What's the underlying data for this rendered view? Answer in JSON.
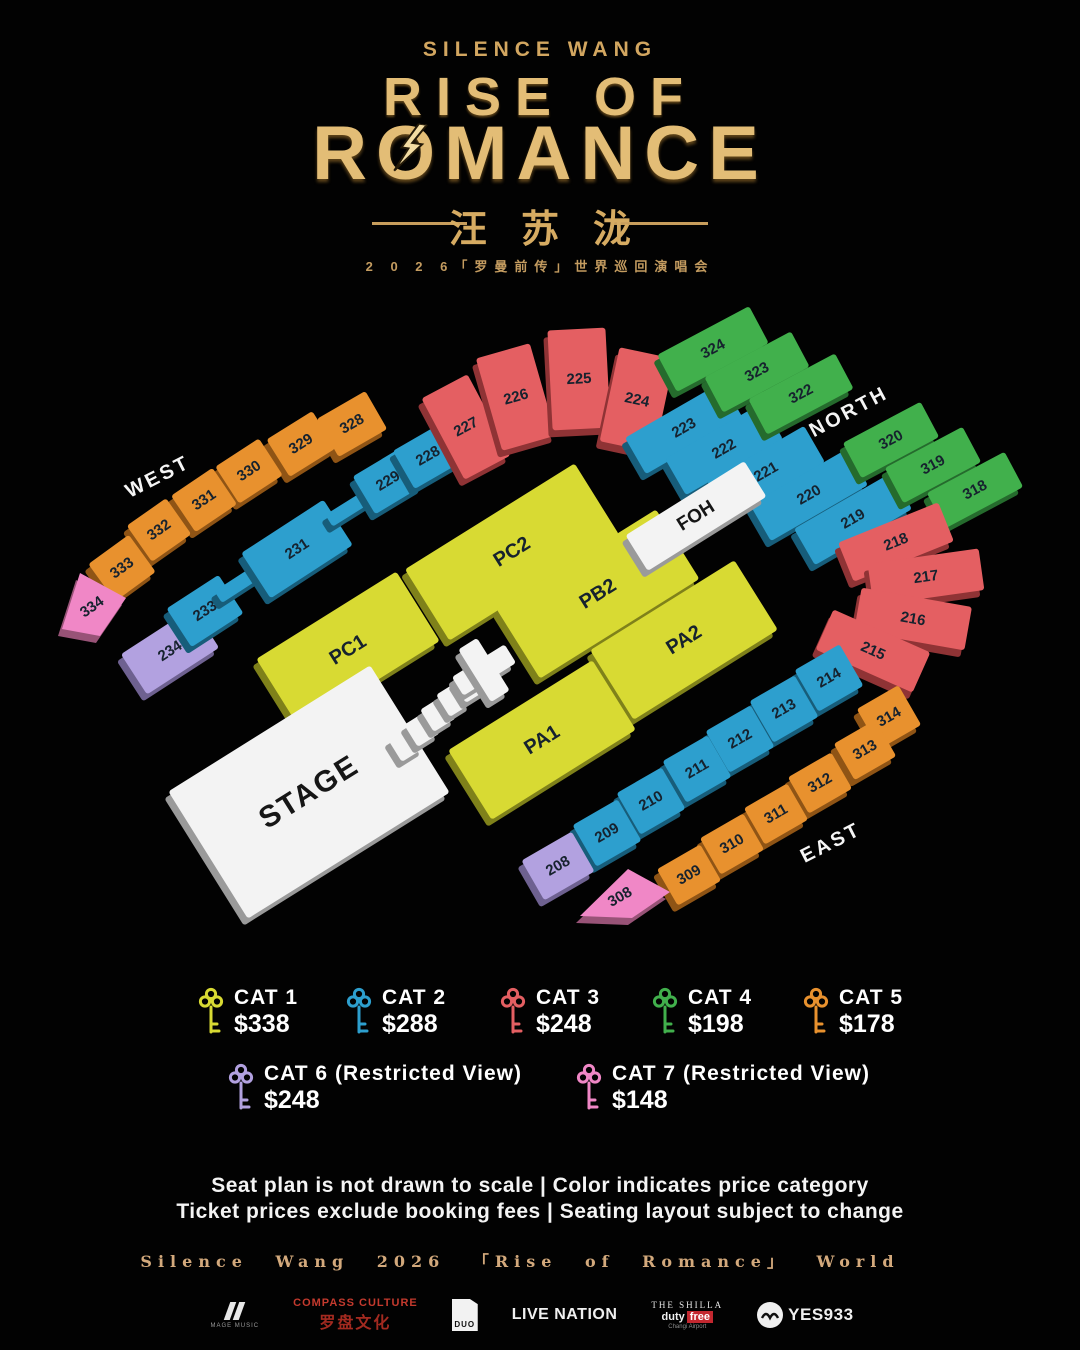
{
  "header": {
    "artist": "SILENCE WANG",
    "title_line1": "RISE OF",
    "title_r": "R",
    "title_o": "O",
    "title_rest": "MANCE",
    "title_cn": "汪苏泷",
    "subtitle": "2 0 2 6「罗曼前传」世界巡回演唱会"
  },
  "map": {
    "label_color": "#16222e",
    "compass": [
      {
        "label": "WEST",
        "x": 158,
        "y": 477,
        "rot": -27
      },
      {
        "label": "NORTH",
        "x": 849,
        "y": 412,
        "rot": -28
      },
      {
        "label": "EAST",
        "x": 831,
        "y": 843,
        "rot": -27
      }
    ],
    "sections": [
      {
        "id": "328",
        "cat": "cat5",
        "cx": 352,
        "cy": 424,
        "w": 56,
        "h": 44,
        "rot": -30
      },
      {
        "id": "329",
        "cat": "cat5",
        "cx": 301,
        "cy": 444,
        "w": 54,
        "h": 44,
        "rot": -32
      },
      {
        "id": "330",
        "cat": "cat5",
        "cx": 249,
        "cy": 471,
        "w": 52,
        "h": 44,
        "rot": -33
      },
      {
        "id": "331",
        "cat": "cat5",
        "cx": 204,
        "cy": 500,
        "w": 50,
        "h": 44,
        "rot": -34
      },
      {
        "id": "332",
        "cat": "cat5",
        "cx": 159,
        "cy": 530,
        "w": 48,
        "h": 44,
        "rot": -35
      },
      {
        "id": "333",
        "cat": "cat5",
        "cx": 122,
        "cy": 568,
        "w": 50,
        "h": 46,
        "rot": -36
      },
      {
        "id": "334",
        "cat": "cat7",
        "shape": "poly",
        "points": "62,629 80,573 126,598 100,636",
        "lx": 92,
        "ly": 607,
        "rot": -35
      },
      {
        "id": "234",
        "cat": "cat6",
        "cx": 170,
        "cy": 651,
        "w": 86,
        "h": 48,
        "rot": -33
      },
      {
        "id": "233",
        "cat": "cat2",
        "cx": 205,
        "cy": 611,
        "w": 62,
        "h": 46,
        "rot": -33
      },
      {
        "id": "",
        "cat": "cat2",
        "cx": 240,
        "cy": 583,
        "w": 52,
        "h": 14,
        "rot": -33
      },
      {
        "id": "231",
        "cat": "cat2",
        "cx": 297,
        "cy": 549,
        "w": 98,
        "h": 54,
        "rot": -33
      },
      {
        "id": "",
        "cat": "cat2",
        "cx": 351,
        "cy": 507,
        "w": 52,
        "h": 14,
        "rot": -32
      },
      {
        "id": "229",
        "cat": "cat2",
        "cx": 388,
        "cy": 481,
        "w": 56,
        "h": 44,
        "rot": -31
      },
      {
        "id": "228",
        "cat": "cat2",
        "cx": 428,
        "cy": 456,
        "w": 56,
        "h": 44,
        "rot": -30
      },
      {
        "id": "227",
        "cat": "cat3",
        "cx": 466,
        "cy": 427,
        "w": 52,
        "h": 92,
        "rot": -28
      },
      {
        "id": "226",
        "cat": "cat3",
        "cx": 516,
        "cy": 397,
        "w": 56,
        "h": 96,
        "rot": -16
      },
      {
        "id": "225",
        "cat": "cat3",
        "cx": 579,
        "cy": 379,
        "w": 58,
        "h": 100,
        "rot": -3
      },
      {
        "id": "224",
        "cat": "cat3",
        "cx": 637,
        "cy": 400,
        "w": 56,
        "h": 96,
        "rot": 12
      },
      {
        "id": "223",
        "cat": "cat2",
        "cx": 684,
        "cy": 428,
        "w": 112,
        "h": 42,
        "rot": -30
      },
      {
        "id": "222",
        "cat": "cat2",
        "cx": 724,
        "cy": 449,
        "w": 112,
        "h": 42,
        "rot": -30
      },
      {
        "id": "221",
        "cat": "cat2",
        "cx": 766,
        "cy": 472,
        "w": 112,
        "h": 42,
        "rot": -30
      },
      {
        "id": "220",
        "cat": "cat2",
        "cx": 809,
        "cy": 495,
        "w": 112,
        "h": 42,
        "rot": -30
      },
      {
        "id": "219",
        "cat": "cat2",
        "cx": 853,
        "cy": 519,
        "w": 112,
        "h": 42,
        "rot": -30
      },
      {
        "id": "324",
        "cat": "cat4",
        "cx": 713,
        "cy": 349,
        "w": 104,
        "h": 42,
        "rot": -28
      },
      {
        "id": "323",
        "cat": "cat4",
        "cx": 757,
        "cy": 372,
        "w": 98,
        "h": 40,
        "rot": -28
      },
      {
        "id": "322",
        "cat": "cat4",
        "cx": 801,
        "cy": 394,
        "w": 98,
        "h": 40,
        "rot": -28
      },
      {
        "id": "320",
        "cat": "cat4",
        "cx": 891,
        "cy": 440,
        "w": 88,
        "h": 40,
        "rot": -28
      },
      {
        "id": "319",
        "cat": "cat4",
        "cx": 933,
        "cy": 465,
        "w": 88,
        "h": 40,
        "rot": -28
      },
      {
        "id": "318",
        "cat": "cat4",
        "cx": 975,
        "cy": 490,
        "w": 88,
        "h": 40,
        "rot": -28
      },
      {
        "id": "218",
        "cat": "cat3",
        "cx": 896,
        "cy": 542,
        "w": 108,
        "h": 42,
        "rot": -22
      },
      {
        "id": "217",
        "cat": "cat3",
        "cx": 926,
        "cy": 577,
        "w": 112,
        "h": 42,
        "rot": -8
      },
      {
        "id": "216",
        "cat": "cat3",
        "cx": 913,
        "cy": 619,
        "w": 112,
        "h": 44,
        "rot": 10
      },
      {
        "id": "215",
        "cat": "cat3",
        "cx": 873,
        "cy": 651,
        "w": 106,
        "h": 44,
        "rot": 24
      },
      {
        "id": "214",
        "cat": "cat2",
        "cx": 829,
        "cy": 678,
        "w": 52,
        "h": 48,
        "rot": -30
      },
      {
        "id": "213",
        "cat": "cat2",
        "cx": 784,
        "cy": 709,
        "w": 52,
        "h": 48,
        "rot": -30
      },
      {
        "id": "212",
        "cat": "cat2",
        "cx": 740,
        "cy": 739,
        "w": 52,
        "h": 48,
        "rot": -30
      },
      {
        "id": "211",
        "cat": "cat2",
        "cx": 697,
        "cy": 769,
        "w": 52,
        "h": 48,
        "rot": -30
      },
      {
        "id": "210",
        "cat": "cat2",
        "cx": 651,
        "cy": 801,
        "w": 52,
        "h": 48,
        "rot": -30
      },
      {
        "id": "209",
        "cat": "cat2",
        "cx": 607,
        "cy": 833,
        "w": 52,
        "h": 48,
        "rot": -30
      },
      {
        "id": "208",
        "cat": "cat6",
        "cx": 558,
        "cy": 866,
        "w": 58,
        "h": 46,
        "rot": -30
      },
      {
        "id": "314",
        "cat": "cat5",
        "cx": 889,
        "cy": 717,
        "w": 48,
        "h": 46,
        "rot": -30
      },
      {
        "id": "313",
        "cat": "cat5",
        "cx": 865,
        "cy": 750,
        "w": 48,
        "h": 42,
        "rot": -30
      },
      {
        "id": "312",
        "cat": "cat5",
        "cx": 820,
        "cy": 783,
        "w": 50,
        "h": 42,
        "rot": -30
      },
      {
        "id": "311",
        "cat": "cat5",
        "cx": 776,
        "cy": 814,
        "w": 50,
        "h": 42,
        "rot": -30
      },
      {
        "id": "310",
        "cat": "cat5",
        "cx": 732,
        "cy": 844,
        "w": 50,
        "h": 42,
        "rot": -30
      },
      {
        "id": "309",
        "cat": "cat5",
        "cx": 689,
        "cy": 875,
        "w": 50,
        "h": 42,
        "rot": -30
      },
      {
        "id": "308",
        "cat": "cat7",
        "shape": "poly",
        "points": "580,916 628,869 670,892 632,918",
        "lx": 620,
        "ly": 897,
        "rot": -30
      },
      {
        "id": "PC1",
        "cat": "cat1",
        "cx": 348,
        "cy": 650,
        "w": 165,
        "h": 82,
        "rot": -32,
        "fs": 20
      },
      {
        "id": "PC2",
        "cat": "cat1",
        "cx": 512,
        "cy": 552,
        "w": 200,
        "h": 84,
        "rot": -32,
        "fs": 20
      },
      {
        "id": "PB2",
        "cat": "cat1",
        "cx": 598,
        "cy": 594,
        "w": 188,
        "h": 82,
        "rot": -32,
        "fs": 20
      },
      {
        "id": "PA2",
        "cat": "cat1",
        "cx": 684,
        "cy": 640,
        "w": 170,
        "h": 82,
        "rot": -32,
        "fs": 20
      },
      {
        "id": "PA1",
        "cat": "cat1",
        "cx": 542,
        "cy": 740,
        "w": 170,
        "h": 82,
        "rot": -32,
        "fs": 20
      },
      {
        "id": "FOH",
        "cat": "white",
        "cx": 696,
        "cy": 516,
        "w": 140,
        "h": 42,
        "rot": -32,
        "fs": 19
      },
      {
        "id": "STAGE",
        "cat": "white",
        "cx": 309,
        "cy": 792,
        "w": 238,
        "h": 150,
        "rot": -32,
        "fs": 30
      },
      {
        "id": "",
        "cat": "white",
        "cx": 406,
        "cy": 744,
        "w": 26,
        "h": 26,
        "rot": -32
      },
      {
        "id": "",
        "cat": "white",
        "cx": 422,
        "cy": 729,
        "w": 26,
        "h": 26,
        "rot": -32
      },
      {
        "id": "",
        "cat": "white",
        "cx": 438,
        "cy": 714,
        "w": 26,
        "h": 26,
        "rot": -32
      },
      {
        "id": "",
        "cat": "white",
        "cx": 454,
        "cy": 699,
        "w": 26,
        "h": 26,
        "rot": -32
      },
      {
        "id": "",
        "cat": "white",
        "cx": 470,
        "cy": 685,
        "w": 26,
        "h": 26,
        "rot": -32
      },
      {
        "id": "",
        "cat": "white",
        "cx": 484,
        "cy": 670,
        "w": 62,
        "h": 22,
        "rot": -32
      },
      {
        "id": "",
        "cat": "white",
        "cx": 484,
        "cy": 670,
        "w": 22,
        "h": 62,
        "rot": -32
      }
    ]
  },
  "legend": {
    "categories": {
      "cat1": {
        "color": "#d8da33",
        "dark": "#7f811a"
      },
      "cat2": {
        "color": "#2d9fce",
        "dark": "#175d7a"
      },
      "cat3": {
        "color": "#e45f62",
        "dark": "#8f3335"
      },
      "cat4": {
        "color": "#41b04c",
        "dark": "#256b2d"
      },
      "cat5": {
        "color": "#e8912e",
        "dark": "#8f5415"
      },
      "cat6": {
        "color": "#b2a1e0",
        "dark": "#6e6190"
      },
      "cat7": {
        "color": "#f087c6",
        "dark": "#985377"
      },
      "white": {
        "color": "#f3f3f3",
        "dark": "#9a9a9a"
      }
    },
    "items_row1": [
      {
        "label": "CAT 1",
        "price": "$338",
        "cat": "cat1",
        "x": 198,
        "y": 986
      },
      {
        "label": "CAT 2",
        "price": "$288",
        "cat": "cat2",
        "x": 346,
        "y": 986
      },
      {
        "label": "CAT 3",
        "price": "$248",
        "cat": "cat3",
        "x": 500,
        "y": 986
      },
      {
        "label": "CAT 4",
        "price": "$198",
        "cat": "cat4",
        "x": 652,
        "y": 986
      },
      {
        "label": "CAT 5",
        "price": "$178",
        "cat": "cat5",
        "x": 803,
        "y": 986
      }
    ],
    "items_row2": [
      {
        "label": "CAT 6 (Restricted View)",
        "price": "$248",
        "cat": "cat6",
        "x": 228,
        "y": 1062
      },
      {
        "label": "CAT 7 (Restricted View)",
        "price": "$148",
        "cat": "cat7",
        "x": 576,
        "y": 1062
      }
    ]
  },
  "footer": {
    "line1": "Seat plan is not drawn to scale | Color indicates price category",
    "line2": "Ticket prices exclude booking fees | Seating layout subject to change",
    "credit": "Silence Wang 2026 「Rise of Romance」 World",
    "sponsors": {
      "mage": {
        "name": "MAGE MUSIC"
      },
      "compass": {
        "line1": "COMPASS CULTURE",
        "line2": "罗盘文化"
      },
      "duo": {
        "name": "DUO"
      },
      "livenation": {
        "name": "LIVE NATION"
      },
      "shilla": {
        "line1": "THE SHILLA",
        "duty": "duty",
        "free": "free",
        "line3": "Changi Airport"
      },
      "yes933": {
        "name": "YES933"
      }
    }
  }
}
